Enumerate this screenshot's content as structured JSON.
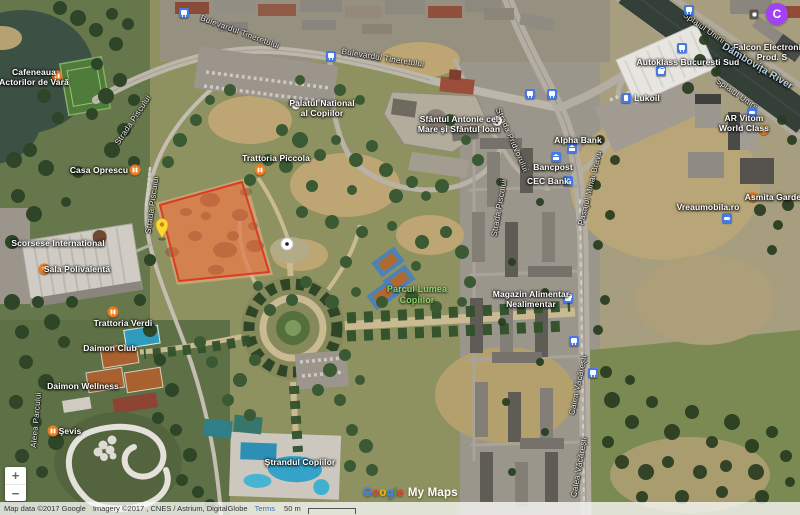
{
  "ui": {
    "avatar_label": "C",
    "zoom_in": "+",
    "zoom_out": "−",
    "watermark": {
      "letters": [
        "G",
        "o",
        "o",
        "g",
        "l",
        "e"
      ],
      "suffix": "My Maps"
    },
    "attribution": {
      "map_data": "Map data ©2017 Google",
      "imagery": "Imagery ©2017 , CNES / Astrium, DigitalGlobe",
      "terms": "Terms",
      "scale_label": "50 m"
    }
  },
  "colors": {
    "selected_polygon_fill": "#ea5728",
    "selected_polygon_stroke": "#dc3b24",
    "pin_yellow": "#fdd835",
    "poi_orange": "#ed7d1f",
    "poi_blue": "#4779e4",
    "park_label_green": "#8ed16f",
    "water_label_blue": "#b9d4e6",
    "avatar_purple": "#a142f4"
  },
  "pois": [
    {
      "id": "cafeneaua-actorilor",
      "lines": [
        "Cafeneaua",
        "Actorilor de Vară"
      ]
    },
    {
      "id": "casa-oprescu",
      "lines": [
        "Casa Oprescu"
      ]
    },
    {
      "id": "trattoria-piccola",
      "lines": [
        "Trattoria Piccola"
      ]
    },
    {
      "id": "palatul-copiilor",
      "lines": [
        "Palatul National",
        "al Copiilor"
      ]
    },
    {
      "id": "sfantul-antonie",
      "lines": [
        "Sfântul Antonie cel",
        "Mare şi Sfântul Ioan"
      ]
    },
    {
      "id": "alpha-bank",
      "lines": [
        "Alpha Bank"
      ]
    },
    {
      "id": "bancpost",
      "lines": [
        "Bancpost"
      ]
    },
    {
      "id": "cec-bank",
      "lines": [
        "CEC Bank"
      ]
    },
    {
      "id": "parcul-lumea-copiilor",
      "lines": [
        "Parcul Lumea",
        "Copiilor"
      ]
    },
    {
      "id": "magazin-alimentar",
      "lines": [
        "Magazin Alimentar",
        "Nealimentar"
      ]
    },
    {
      "id": "autoklass",
      "lines": [
        "Autoklass Bucuresti Sud"
      ]
    },
    {
      "id": "falcon-electronics",
      "lines": [
        "Falcon Electronics",
        "Prod. S"
      ]
    },
    {
      "id": "dambovita-river",
      "lines": [
        "Dâmbovița River"
      ]
    },
    {
      "id": "lukoil",
      "lines": [
        "Lukoil"
      ]
    },
    {
      "id": "ar-vitom-world-class",
      "lines": [
        "AR Vitom",
        "World Class"
      ]
    },
    {
      "id": "vreaumobila",
      "lines": [
        "Vreaumobila.ro"
      ]
    },
    {
      "id": "asmita-gardens",
      "lines": [
        "Asmita Gardens"
      ]
    },
    {
      "id": "scorsese-international",
      "lines": [
        "Scorsese International"
      ]
    },
    {
      "id": "sala-polivalenta",
      "lines": [
        "Sala Polivalentă"
      ]
    },
    {
      "id": "trattoria-verdi",
      "lines": [
        "Trattoria Verdi"
      ]
    },
    {
      "id": "daimon-club",
      "lines": [
        "Daimon Club"
      ]
    },
    {
      "id": "daimon-wellness",
      "lines": [
        "Daimon Wellness"
      ]
    },
    {
      "id": "sevis",
      "lines": [
        "Şevis"
      ]
    },
    {
      "id": "strandul-copiilor",
      "lines": [
        "Ştrandul Copiilor"
      ]
    }
  ],
  "streets": [
    {
      "text": "Bulevardul Tineretului"
    },
    {
      "text": "Bulevardul Tineretului"
    },
    {
      "text": "Strada Pridvorului"
    },
    {
      "text": "Strada Piscului"
    },
    {
      "text": "Pasajul Mihai Bravu"
    },
    {
      "text": "Calea Văcărești"
    },
    {
      "text": "Calea Văcărești"
    },
    {
      "text": "Splaiul Unirii"
    },
    {
      "text": "Splaiul Unirii"
    },
    {
      "text": "Strada Piscului"
    },
    {
      "text": "Strada Piscului"
    },
    {
      "text": "Aleea Parcului"
    }
  ]
}
